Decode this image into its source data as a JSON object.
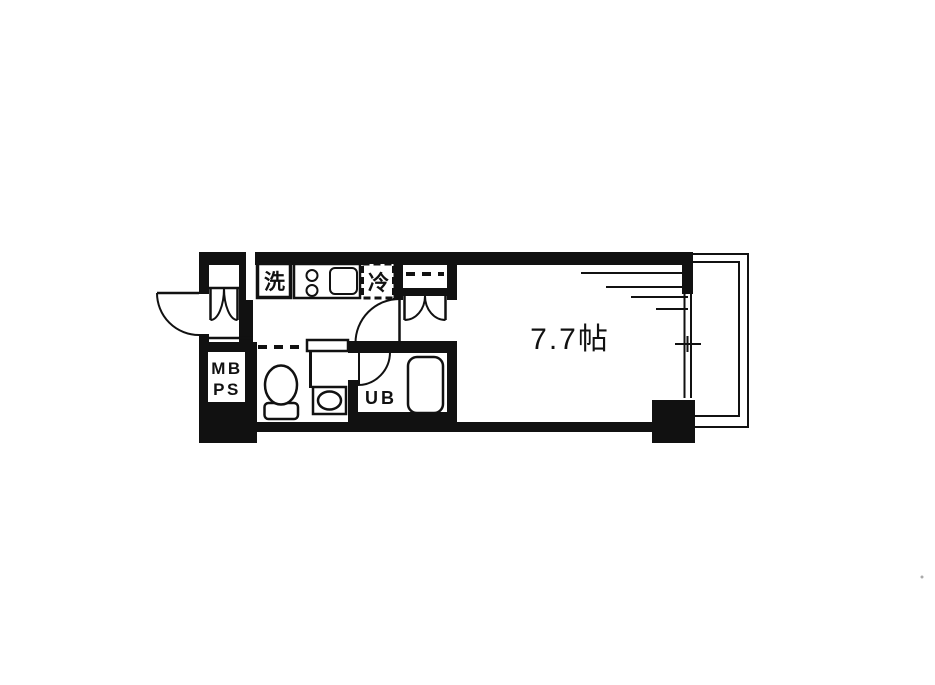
{
  "floorplan": {
    "room_size_label": "7.7帖",
    "labels": {
      "washer": "洗",
      "fridge": "冷",
      "unit_bath": "UB",
      "meter_box": "MB",
      "pipe_space": "PS"
    },
    "colors": {
      "line": "#111111",
      "background": "#ffffff"
    }
  }
}
